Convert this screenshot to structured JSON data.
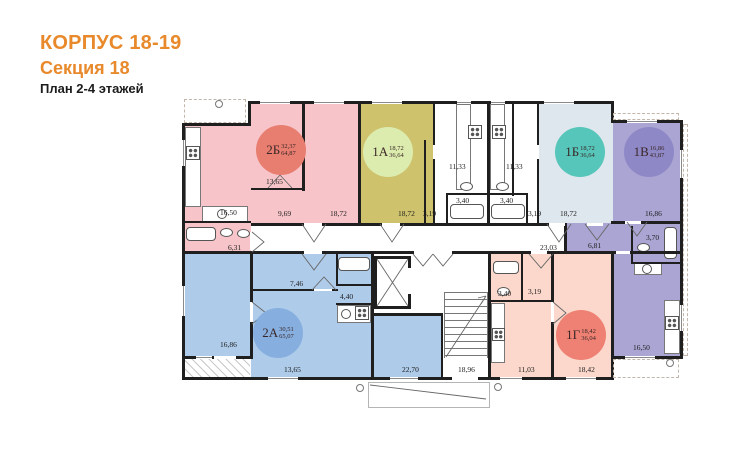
{
  "header": {
    "building": "КОРПУС 18-19",
    "section": "Секция 18",
    "plan_title": "План 2-4 этажей",
    "accent": "#E8892B"
  },
  "plan": {
    "apartments": [
      {
        "code": "2Б",
        "living_area": "32,37",
        "total_area": "64,87",
        "fill": "#F7C5C9",
        "badge_color": "#E77E70",
        "rooms": [
          {
            "area": "16,50"
          },
          {
            "area": "6,31"
          },
          {
            "area": "13,65"
          },
          {
            "area": "9,69"
          },
          {
            "area": "18,72"
          }
        ]
      },
      {
        "code": "1А",
        "living_area": "18,72",
        "total_area": "36,64",
        "fill": "#CFC26D",
        "badge_color": "#DCECAE",
        "rooms": [
          {
            "area": "18,72"
          },
          {
            "area": "3,19"
          },
          {
            "area": "11,33"
          },
          {
            "area": "3,40"
          }
        ]
      },
      {
        "code": "1Б",
        "living_area": "18,72",
        "total_area": "36,64",
        "fill": "#DFE7EE",
        "badge_color": "#55C6B9",
        "rooms": [
          {
            "area": "11,33"
          },
          {
            "area": "3,40"
          },
          {
            "area": "3,19"
          },
          {
            "area": "18,72"
          }
        ]
      },
      {
        "code": "1В",
        "living_area": "16,86",
        "total_area": "43,87",
        "fill": "#AAA5D3",
        "badge_color": "#8E88C7",
        "rooms": [
          {
            "area": "16,86"
          },
          {
            "area": "6,81"
          },
          {
            "area": "3,70"
          },
          {
            "area": "16,50"
          }
        ]
      },
      {
        "code": "2А",
        "living_area": "30,51",
        "total_area": "65,07",
        "fill": "#AECBE9",
        "badge_color": "#86AFDF",
        "rooms": [
          {
            "area": "16,86"
          },
          {
            "area": "7,46"
          },
          {
            "area": "4,40"
          },
          {
            "area": "13,65"
          },
          {
            "area": "22,70"
          }
        ]
      },
      {
        "code": "1Г",
        "living_area": "18,42",
        "total_area": "36,04",
        "fill": "#FBD8CB",
        "badge_color": "#EE8173",
        "rooms": [
          {
            "area": "3,40"
          },
          {
            "area": "3,19"
          },
          {
            "area": "11,03"
          },
          {
            "area": "18,42"
          }
        ]
      }
    ],
    "common": {
      "corridor_area": "23,03",
      "stairs_area": "18,96"
    }
  }
}
